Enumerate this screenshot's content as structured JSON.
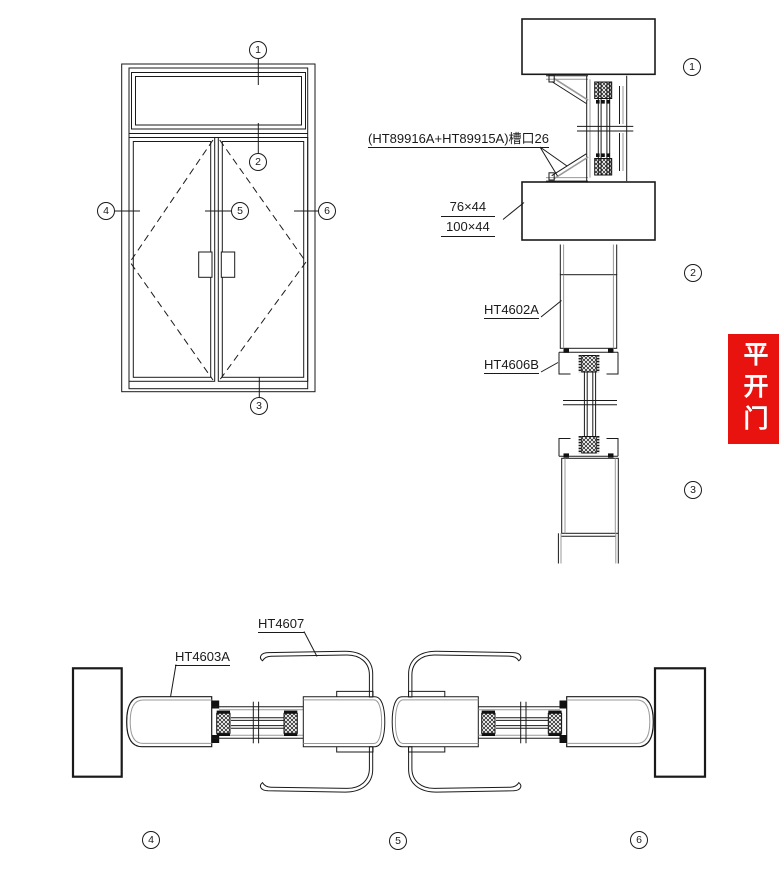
{
  "drawing": {
    "banner": {
      "text": "平开门",
      "bg_color": "#e8130f",
      "text_color": "#ffffff"
    },
    "callouts": {
      "n1": "1",
      "n2": "2",
      "n3": "3",
      "n4": "4",
      "n5": "5",
      "n6": "6"
    },
    "labels": {
      "groove": "(HT89916A+HT89915A)槽口26",
      "dim_upper": "76×44",
      "dim_lower": "100×44",
      "head_profile": "HT4602A",
      "leaf_top_profile": "HT4606B",
      "astragal_profile": "HT4607",
      "jamb_profile": "HT4603A"
    },
    "colors": {
      "line": "#1a1a1a",
      "profile_inner": "#999999",
      "hatch": "#111111"
    }
  }
}
